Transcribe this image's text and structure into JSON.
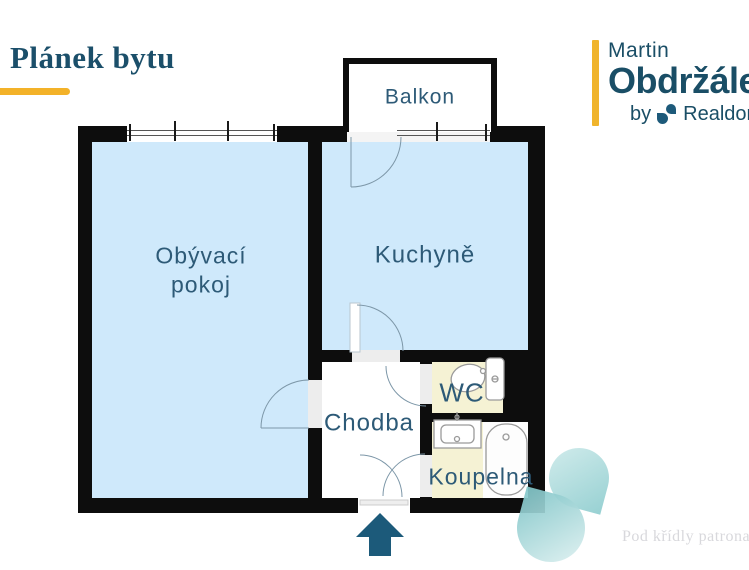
{
  "header": {
    "title": "Plánek bytu"
  },
  "logo": {
    "first_name": "Martin",
    "last_name": "Obdržálek",
    "by_label": "by",
    "brand": "Realdomu"
  },
  "plan": {
    "rooms": {
      "balkon": {
        "label": "Balkon"
      },
      "obyvaci_pokoj": {
        "line1": "Obývací",
        "line2": "pokoj"
      },
      "kuchyne": {
        "label": "Kuchyně"
      },
      "chodba": {
        "label": "Chodba"
      },
      "wc": {
        "label": "WC"
      },
      "koupelna": {
        "label": "Koupelna"
      }
    },
    "icons": {
      "toilet": "toilet-icon",
      "sink": "sink-icon",
      "bathtub": "bathtub-icon",
      "entrance": "arrow-up-icon",
      "brand_swirl": "realdomus-swirl-icon",
      "watermark_swirl": "watermark-swirl-icon"
    }
  },
  "watermark": {
    "tagline": "Pod křídly patrona r"
  },
  "colors": {
    "accent_yellow": "#F3B229",
    "brand_teal": "#1A4E66",
    "label_teal": "#2D5A77",
    "room_blue": "#CFE9FB",
    "room_yellow": "#F5F2D4",
    "wall_black": "#0D0D0D",
    "arrow_teal": "#1C5A7A",
    "watermark_teal": "#8FCDCF"
  }
}
